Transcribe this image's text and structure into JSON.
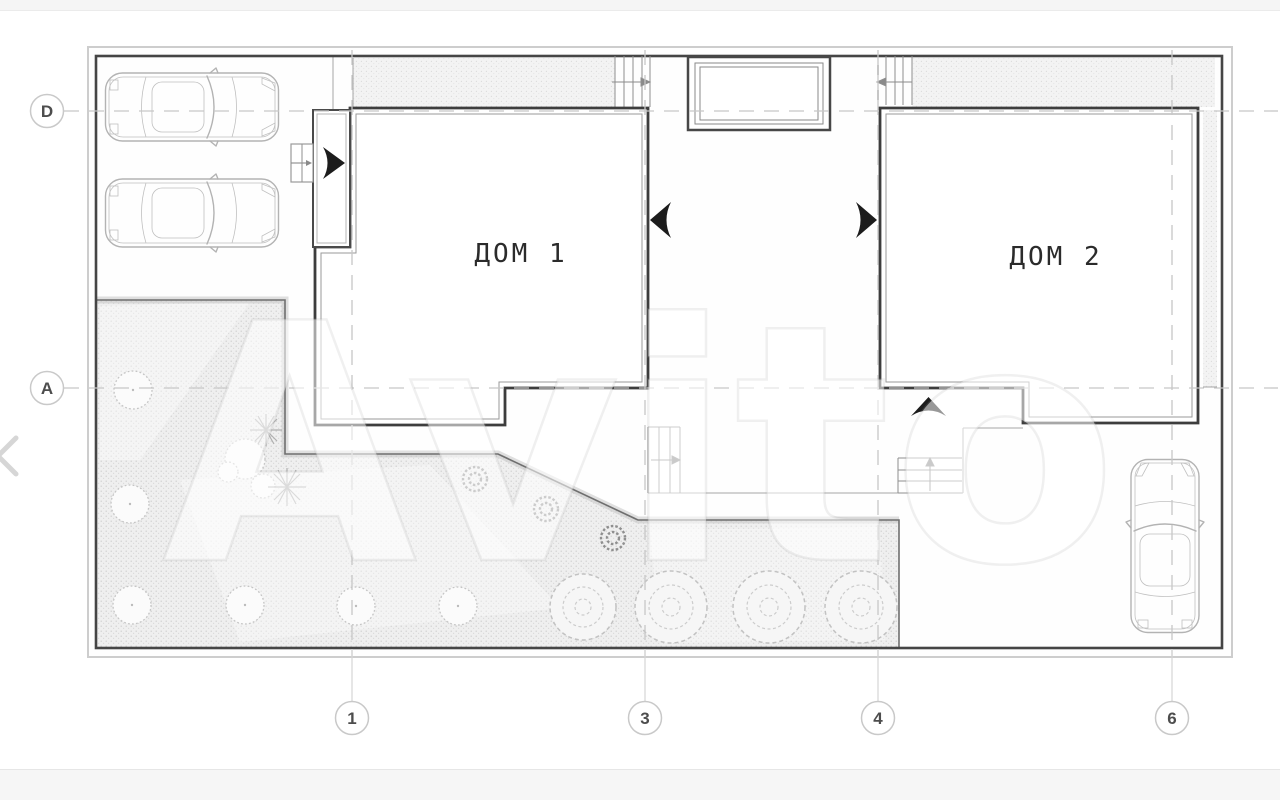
{
  "plan": {
    "houses": [
      {
        "label": "ДОМ 1"
      },
      {
        "label": "ДОМ 2"
      }
    ],
    "grid_rows": [
      {
        "label": "D"
      },
      {
        "label": "A"
      }
    ],
    "grid_cols": [
      {
        "label": "1"
      },
      {
        "label": "3"
      },
      {
        "label": "4"
      },
      {
        "label": "6"
      }
    ]
  },
  "watermark": {
    "text": "Avito"
  },
  "carousel": {
    "prev_icon": "chevron-left"
  },
  "colors": {
    "wall": "#3d3d3d",
    "drawing_line": "#8f8f8f",
    "light_line": "#c7c7c7",
    "texture_dot": "#cfcfcf",
    "bubble_border": "#c9c9c9",
    "bubble_text": "#4d4d4d",
    "swing_arrow": "#1c1c1c",
    "page_band": "#f5f5f5"
  }
}
